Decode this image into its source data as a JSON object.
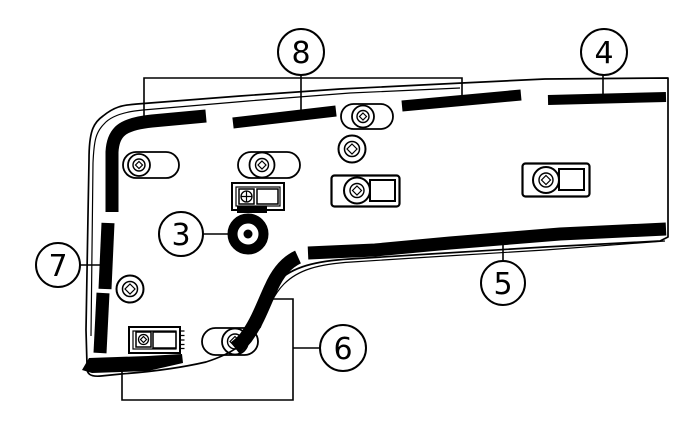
{
  "figure": {
    "type": "parts-location-diagram",
    "background_color": "#ffffff",
    "line_color": "#000000",
    "callouts": [
      {
        "label": "3",
        "points_to": "grommet"
      },
      {
        "label": "4",
        "points_to": "top-right-band"
      },
      {
        "label": "5",
        "points_to": "lower-band"
      },
      {
        "label": "6",
        "points_to": "lower-left-bands"
      },
      {
        "label": "7",
        "points_to": "left-band"
      },
      {
        "label": "8",
        "points_to": "top-left-band"
      }
    ],
    "symbols": {
      "oval_clip_count": 4,
      "round_pin_clip_count": 2,
      "rectangular_clip_count": 4,
      "grommet_count": 1
    }
  }
}
